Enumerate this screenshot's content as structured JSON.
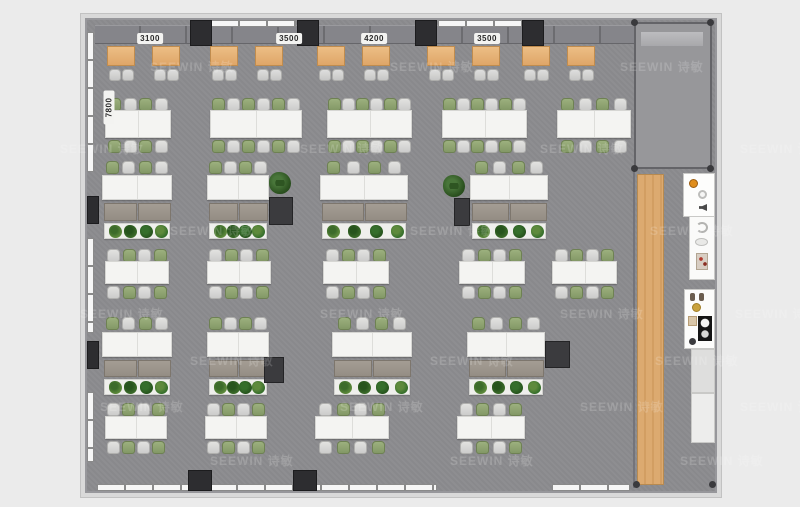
{
  "watermark": {
    "text": "SEEWIN 诗敏",
    "positions": [
      [
        150,
        58
      ],
      [
        390,
        58
      ],
      [
        620,
        58
      ],
      [
        60,
        140
      ],
      [
        300,
        140
      ],
      [
        540,
        140
      ],
      [
        740,
        140
      ],
      [
        170,
        222
      ],
      [
        410,
        222
      ],
      [
        650,
        222
      ],
      [
        80,
        305
      ],
      [
        320,
        305
      ],
      [
        560,
        305
      ],
      [
        735,
        305
      ],
      [
        190,
        352
      ],
      [
        430,
        352
      ],
      [
        655,
        352
      ],
      [
        100,
        398
      ],
      [
        340,
        398
      ],
      [
        580,
        398
      ],
      [
        740,
        398
      ],
      [
        210,
        452
      ],
      [
        450,
        452
      ],
      [
        680,
        452
      ]
    ]
  },
  "dimensions": {
    "top_labels": [
      {
        "label": "3100",
        "cx": 63
      },
      {
        "label": "3500",
        "cx": 202
      },
      {
        "label": "4200",
        "cx": 287
      },
      {
        "label": "3500",
        "cx": 400
      }
    ],
    "left_label": {
      "label": "7800",
      "x": 5,
      "y": 82
    }
  },
  "colors": {
    "background": "#ebebeb",
    "floor": "#8c8c8f",
    "wall": "#97979b",
    "column": "#2d2d30",
    "desk_wood": "#dfa668",
    "walkway_wood": "#d8a66c",
    "table": "#f4f4f2",
    "chair_green": "#839866",
    "chair_gray": "#cccccb",
    "cabinet": "#948d84",
    "plant_dark": "#2c5220"
  },
  "structure": {
    "top_band": [
      8,
      5,
      540,
      19
    ],
    "top_columns": [
      [
        103,
        0,
        22,
        26
      ],
      [
        210,
        0,
        22,
        26
      ],
      [
        328,
        0,
        22,
        26
      ],
      [
        435,
        0,
        22,
        26
      ]
    ],
    "top_windows": [
      [
        124,
        0,
        85,
        7
      ],
      [
        351,
        0,
        85,
        7
      ]
    ],
    "left_windows": [
      [
        0,
        12,
        7,
        140
      ],
      [
        0,
        218,
        7,
        95
      ],
      [
        0,
        372,
        7,
        70
      ]
    ],
    "left_columns": [
      [
        0,
        176,
        12,
        28
      ],
      [
        0,
        321,
        12,
        28
      ]
    ],
    "bottom_windows": [
      [
        10,
        464,
        340,
        7
      ],
      [
        465,
        464,
        78,
        7
      ]
    ],
    "bottom_columns": [
      [
        101,
        450,
        24,
        21
      ],
      [
        206,
        450,
        24,
        21
      ]
    ],
    "divider": [
      546,
      150,
      2,
      318
    ],
    "wood_strip": [
      550,
      154,
      27,
      311
    ],
    "glass_room": {
      "x": 547,
      "y": 2,
      "w": 78,
      "h": 147,
      "band": [
        5,
        8,
        62,
        14
      ]
    },
    "corner_dots": [
      [
        544,
        -1
      ],
      [
        620,
        -1
      ],
      [
        544,
        145
      ],
      [
        620,
        145
      ],
      [
        546,
        461
      ],
      [
        622,
        461
      ]
    ]
  },
  "furniture": {
    "booths": {
      "y": 26,
      "desk_w": 28,
      "desk_h": 20,
      "pair_x": [
        20,
        123,
        230,
        340,
        435
      ],
      "second_offset": 45,
      "chair_y": 49
    },
    "table_rows": [
      {
        "chair_top_y": 78,
        "table_y": 90,
        "table_h": 28,
        "chair_bot_y": 120,
        "start": "green",
        "groups": [
          [
            18,
            66,
            4
          ],
          [
            123,
            92,
            6
          ],
          [
            240,
            85,
            6
          ],
          [
            355,
            85,
            6
          ],
          [
            470,
            74,
            4
          ]
        ]
      },
      {
        "chair_top_y": 229,
        "table_y": 241,
        "table_h": 23,
        "chair_bot_y": 266,
        "start": "gray",
        "groups": [
          [
            18,
            64,
            4
          ],
          [
            120,
            64,
            4
          ],
          [
            236,
            66,
            4
          ],
          [
            372,
            66,
            4
          ],
          [
            465,
            65,
            4
          ]
        ]
      },
      {
        "chair_top_y": 383,
        "table_y": 396,
        "table_h": 23,
        "chair_bot_y": 421,
        "start": "gray",
        "groups": [
          [
            18,
            62,
            4
          ],
          [
            118,
            62,
            4
          ],
          [
            228,
            74,
            4
          ],
          [
            370,
            68,
            4
          ]
        ]
      }
    ],
    "desk_rows": [
      {
        "chair_y": 141,
        "table_y": 155,
        "table_h": 25,
        "cab_y": 183,
        "cab_h": 18,
        "planter_y": 203,
        "planter_h": 16,
        "groups": [
          [
            15,
            70
          ],
          [
            120,
            62
          ],
          [
            233,
            88
          ],
          [
            383,
            78
          ]
        ]
      },
      {
        "chair_y": 297,
        "table_y": 312,
        "table_h": 25,
        "cab_y": 340,
        "cab_h": 17,
        "planter_y": 359,
        "planter_h": 16,
        "groups": [
          [
            15,
            70
          ],
          [
            120,
            62
          ],
          [
            245,
            80
          ],
          [
            380,
            78
          ]
        ]
      }
    ],
    "pedestals": [
      [
        182,
        177,
        24,
        28
      ],
      [
        367,
        178,
        16,
        28
      ],
      [
        177,
        337,
        20,
        26
      ],
      [
        458,
        321,
        25,
        27
      ]
    ],
    "standing_plants": [
      [
        182,
        152
      ],
      [
        356,
        155
      ]
    ],
    "plant_shades": [
      "#5e8a3c",
      "#3c6b2a",
      "#27541d",
      "#356e2b"
    ]
  },
  "kitchen": {
    "fixtures": [
      {
        "name": "appliance-counter",
        "x": 597,
        "y": 154,
        "w": 30,
        "h": 42,
        "bg": "#fdfdfc",
        "items": [
          [
            "orange",
            5,
            5
          ],
          [
            "ring",
            14,
            16
          ],
          [
            "speaker",
            15,
            30
          ]
        ]
      },
      {
        "name": "sink-unit",
        "x": 603,
        "y": 197,
        "w": 24,
        "h": 62,
        "bg": "#fafaf9",
        "items": [
          [
            "arc",
            6,
            5
          ],
          [
            "oval",
            5,
            21
          ],
          [
            "panel",
            6,
            36
          ]
        ]
      },
      {
        "name": "prep-counter",
        "x": 598,
        "y": 270,
        "w": 29,
        "h": 58,
        "bg": "#fcfcfb",
        "items": [
          [
            "slipper",
            5,
            3
          ],
          [
            "slipper",
            14,
            3
          ],
          [
            "gold",
            7,
            13
          ],
          [
            "thumb",
            3,
            26
          ],
          [
            "cooktop",
            13,
            26
          ],
          [
            "dot Y",
            4,
            48
          ]
        ]
      },
      {
        "name": "side-counter",
        "x": 605,
        "y": 330,
        "w": 22,
        "h": 42,
        "bg": "#dededd",
        "items": []
      },
      {
        "name": "tall-cabinet",
        "x": 605,
        "y": 374,
        "w": 22,
        "h": 48,
        "bg": "#ededec",
        "items": []
      }
    ]
  }
}
